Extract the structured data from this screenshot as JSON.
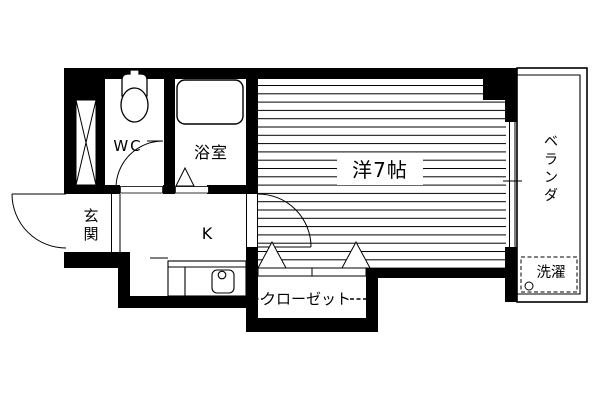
{
  "page": {
    "type": "apartment-floor-plan",
    "background_color": "#ffffff",
    "wall_color": "#000000",
    "line_color": "#000000"
  },
  "rooms": {
    "wc": {
      "label": "WC"
    },
    "bath": {
      "label": "浴室"
    },
    "western_room": {
      "label": "洋7帖"
    },
    "kitchen": {
      "label": "K"
    },
    "entrance": {
      "label": "玄関",
      "chars": [
        "玄",
        "関"
      ]
    },
    "veranda": {
      "label": "ベランダ",
      "chars": [
        "ベ",
        "ラ",
        "ン",
        "ダ"
      ]
    },
    "closet": {
      "label": "クローゼット"
    },
    "laundry": {
      "label": "洗濯"
    }
  },
  "fixtures": {
    "toilet": "toilet-icon",
    "bathtub": "bathtub-icon",
    "kitchen_sink": "sink-icon",
    "faucet": "faucet-icon",
    "washer_space": "washer-space-dashed-box",
    "pipe_shaft": "pipe-shaft-hatch",
    "flooring": "wood-flooring-stripes"
  }
}
